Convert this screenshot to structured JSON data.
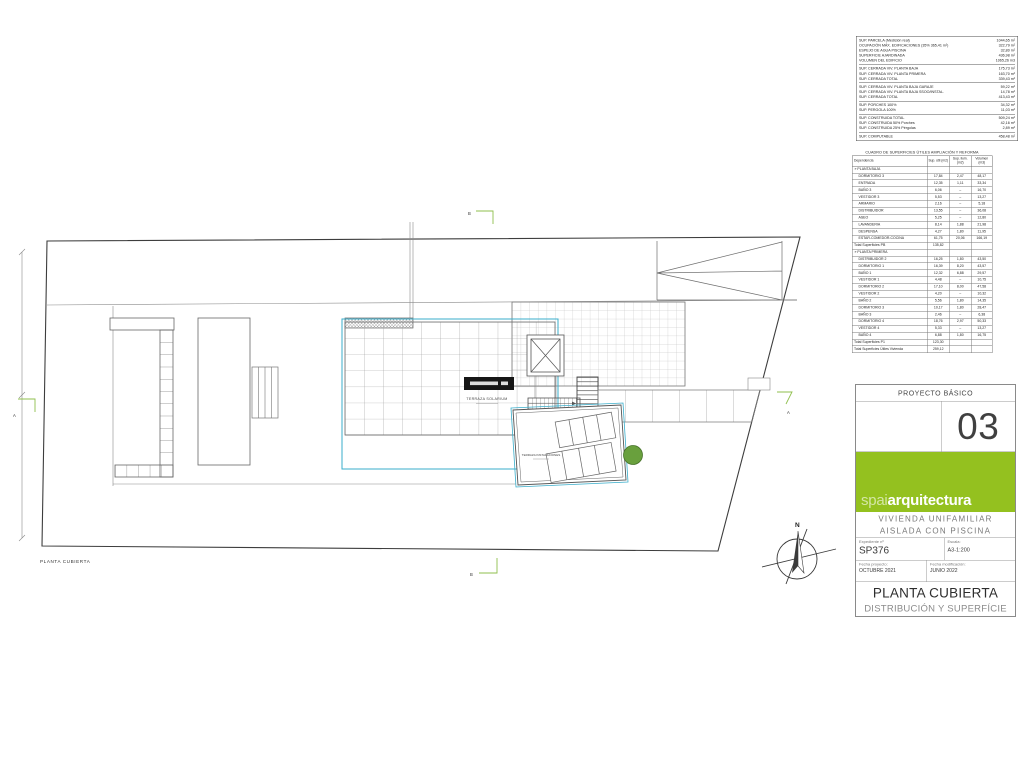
{
  "drawing": {
    "plan_caption": "PLANTA CUBIERTA",
    "label_terraza_solarium": "TERRAZA SOLARIUM",
    "label_terraza_instalaciones": "TERRAZA INSTALACIONES",
    "north": "N",
    "section_a": "A",
    "section_b": "B",
    "accent_cyan": "#3aaecb",
    "marker_green": "#8fbf4d"
  },
  "surface_table": {
    "groups": [
      [
        [
          "SUP. PARCELA (Medición real)",
          "1044,65 m²"
        ],
        [
          "OCUPACIÓN MÁX. EDIFICACIONES (35% 365,41 m²)",
          "322,79 m²"
        ],
        [
          "ESPEJO DE AGUA PISCINA",
          "32,80 m²"
        ],
        [
          "SUPERFICIE AJARDINADA",
          "436,98 m²"
        ],
        [
          "VOLUMEN DEL EDIFICIO",
          "1065,26 m3"
        ]
      ],
      [
        [
          "SUP. CERRADA VIV. PLANTA BAJA",
          "175,73 m²"
        ],
        [
          "SUP. CERRADA VIV. PLANTA PRIMERA",
          "163,70 m²"
        ],
        [
          "SUP. CERRADA TOTAL",
          "339,43 m²"
        ]
      ],
      [
        [
          "SUP. CERRADA VIV. PLANTA BAJA GARAJE",
          "59,22 m²"
        ],
        [
          "SUP. CERRADA VIV. PLANTA BAJA SSOO/INSTAL.",
          "14,78 m²"
        ],
        [
          "SUP. CERRADA TOTAL",
          "413,43 m²"
        ]
      ],
      [
        [
          "SUP. PORCHES 100%",
          "34,32 m²"
        ],
        [
          "SUP. PERGOLA 100%",
          "11,03 m²"
        ]
      ],
      [
        [
          "SUP. CONSTRUIDA TOTAL",
          "509,24 m²"
        ],
        [
          "SUP. CONSTRUIDA 50% Porches",
          "42,16 m²"
        ],
        [
          "SUP. CONSTRUIDA 25% Pérgolas",
          "2,89 m²"
        ]
      ],
      [
        [
          "SUP. COMPUTABLE",
          "458,48 m²"
        ]
      ]
    ]
  },
  "areas_table": {
    "title": "CUADRO DE SUPERFICIES ÚTILES AMPLIACIÓN Y REFORMA",
    "columns": [
      "Dependencia",
      "Sup. útil (m2)",
      "Sup. ilum. (m2)",
      "Volumen (m3)"
    ],
    "rows": [
      [
        "s",
        "» PLANTA BAJA"
      ],
      [
        "r",
        "DORMITORIO 3",
        "17,84",
        "2,47",
        "48,17"
      ],
      [
        "r",
        "ENTRADA",
        "12,35",
        "1,11",
        "33,34"
      ],
      [
        "r",
        "BAÑO 3",
        "6,06",
        "–",
        "16,70"
      ],
      [
        "r",
        "VESTIDOR 3",
        "5,53",
        "–",
        "13,27"
      ],
      [
        "r",
        "ARMARIO",
        "2,16",
        "–",
        "5,18"
      ],
      [
        "r",
        "DISTRIBUIDOR",
        "13,55",
        "–",
        "36,08"
      ],
      [
        "r",
        "ASEO",
        "5,25",
        "–",
        "12,80"
      ],
      [
        "r",
        "LAVANDERIA",
        "8,14",
        "1,88",
        "21,98"
      ],
      [
        "r",
        "DESPENSA",
        "4,27",
        "1,80",
        "11,95"
      ],
      [
        "r",
        "ESTAR-COMEDOR-COCINA",
        "61,75",
        "20,06",
        "166,19"
      ],
      [
        "t",
        "Total Superficies PB",
        "135,82"
      ],
      [
        "s",
        "» PLANTA PRIMERA"
      ],
      [
        "r",
        "DISTRIBUIDOR 2",
        "16,25",
        "1,80",
        "43,50"
      ],
      [
        "r",
        "DORMITORIO 1",
        "16,39",
        "8,20",
        "43,57"
      ],
      [
        "r",
        "BAÑO 1",
        "12,32",
        "6,88",
        "29,57"
      ],
      [
        "r",
        "VESTIDOR 1",
        "4,48",
        "–",
        "10,75"
      ],
      [
        "r",
        "DORMITORIO 2",
        "17,10",
        "8,00",
        "47,58"
      ],
      [
        "r",
        "VESTIDOR 2",
        "4,20",
        "–",
        "10,32"
      ],
      [
        "r",
        "BAÑO 2",
        "5,56",
        "1,80",
        "14,35"
      ],
      [
        "r",
        "DORMITORIO 3",
        "10,17",
        "1,80",
        "28,47"
      ],
      [
        "r",
        "BAÑO 3",
        "2,46",
        "–",
        "6,38"
      ],
      [
        "r",
        "DORMITORIO 4",
        "18,76",
        "2,97",
        "50,33"
      ],
      [
        "r",
        "VESTIDOR 4",
        "5,33",
        "–",
        "13,27"
      ],
      [
        "r",
        "BAÑO 4",
        "6,88",
        "1,80",
        "16,75"
      ],
      [
        "t",
        "Total Superficies P1",
        "123,30"
      ],
      [
        "g",
        "Total Superficies Útiles Vivienda",
        "259,12"
      ]
    ]
  },
  "title_block": {
    "project_type": "PROYECTO BÁSICO",
    "sheet_number": "03",
    "brand_light": "spai",
    "brand_bold": "arquitectura",
    "brand_color": "#94c11f",
    "project_title_line1": "VIVIENDA UNIFAMILIAR",
    "project_title_line2": "AISLADA CON PISCINA",
    "expediente_label": "Expediente nº",
    "expediente_value": "SP376",
    "escala_label": "Escala:",
    "escala_value": "A3-1:200",
    "fecha_proyecto_label": "Fecha proyecto:",
    "fecha_proyecto_value": "OCTUBRE 2021",
    "fecha_modificacion_label": "Fecha modificación:",
    "fecha_modificacion_value": "JUNIO 2022",
    "sheet_title": "PLANTA CUBIERTA",
    "sheet_subtitle": "DISTRIBUCIÓN Y SUPERFÍCIE"
  }
}
